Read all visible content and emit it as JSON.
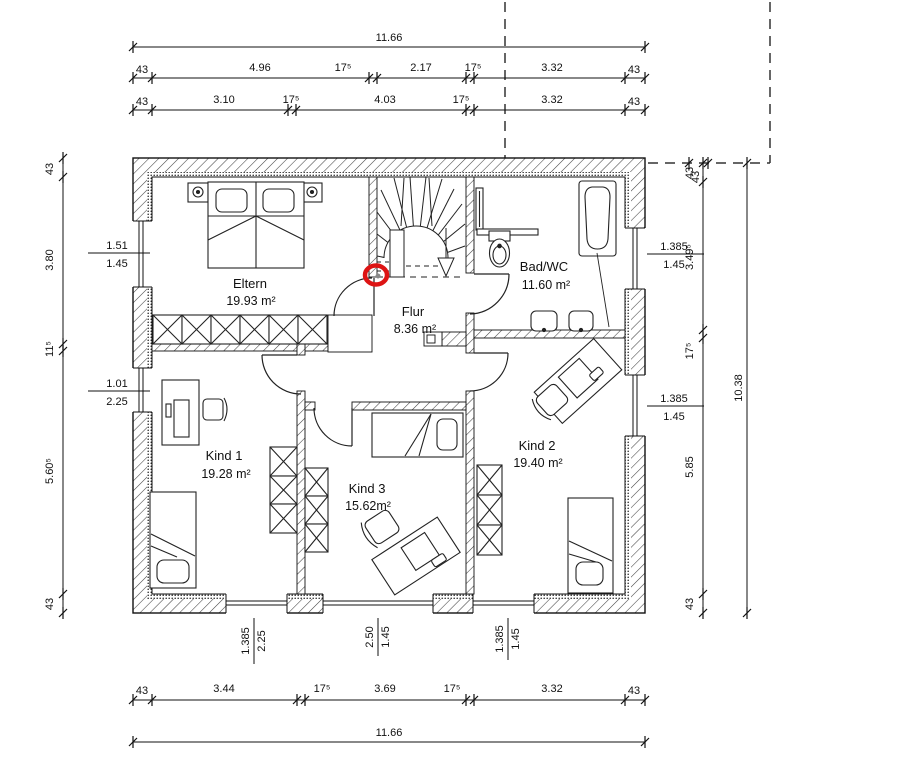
{
  "floor_plan": {
    "highlight_color": "#dd1414",
    "rooms": [
      {
        "name": "Eltern",
        "area": "19.93 m²"
      },
      {
        "name": "Flur",
        "area": "8.36 m²"
      },
      {
        "name": "Bad/WC",
        "area": "11.60 m²"
      },
      {
        "name": "Kind 1",
        "area": "19.28 m²"
      },
      {
        "name": "Kind 3",
        "area": "15.62m²"
      },
      {
        "name": "Kind 2",
        "area": "19.40 m²"
      }
    ],
    "furniture": {
      "eltern": [
        "double-bed",
        "nightstand-left",
        "nightstand-right",
        "wardrobe"
      ],
      "bad_wc": [
        "radiator",
        "counter",
        "toilet",
        "bathtub",
        "sink",
        "sink"
      ],
      "kind1": [
        "desk",
        "chair",
        "bed",
        "wardrobe"
      ],
      "kind3": [
        "bed",
        "desk",
        "chair",
        "wardrobe-left"
      ],
      "kind2": [
        "desk",
        "chair",
        "bed",
        "wardrobe"
      ],
      "flur": [
        "winder-staircase",
        "stair-direction-arrow"
      ]
    }
  },
  "dimensions": {
    "top": {
      "total": "11.66",
      "row2": [
        "43",
        "4.96",
        "17⁵",
        "2.17",
        "17⁵",
        "3.32",
        "43"
      ],
      "row3": [
        "43",
        "3.10",
        "17⁵",
        "4.03",
        "17⁵",
        "3.32",
        "43"
      ]
    },
    "bottom": {
      "chain": [
        "43",
        "3.44",
        "17⁵",
        "3.69",
        "17⁵",
        "3.32",
        "43"
      ],
      "total": "11.66",
      "windows": [
        [
          "1.385",
          "2.25"
        ],
        [
          "2.50",
          "1.45"
        ],
        [
          "1.385",
          "1.45"
        ]
      ]
    },
    "left": {
      "chain": [
        "43",
        "3.80",
        "11⁵",
        "5.60⁵",
        "43"
      ],
      "windows": [
        [
          "1.51",
          "1.45"
        ],
        [
          "1.01",
          "2.25"
        ]
      ]
    },
    "right": {
      "chain": [
        "43",
        "3.49⁵",
        "17⁵",
        "5.85",
        "43"
      ],
      "total": "10.38",
      "roof_offset": "43",
      "windows": [
        [
          "1.385",
          "1.45"
        ],
        [
          "1.385",
          "1.45"
        ]
      ]
    }
  }
}
